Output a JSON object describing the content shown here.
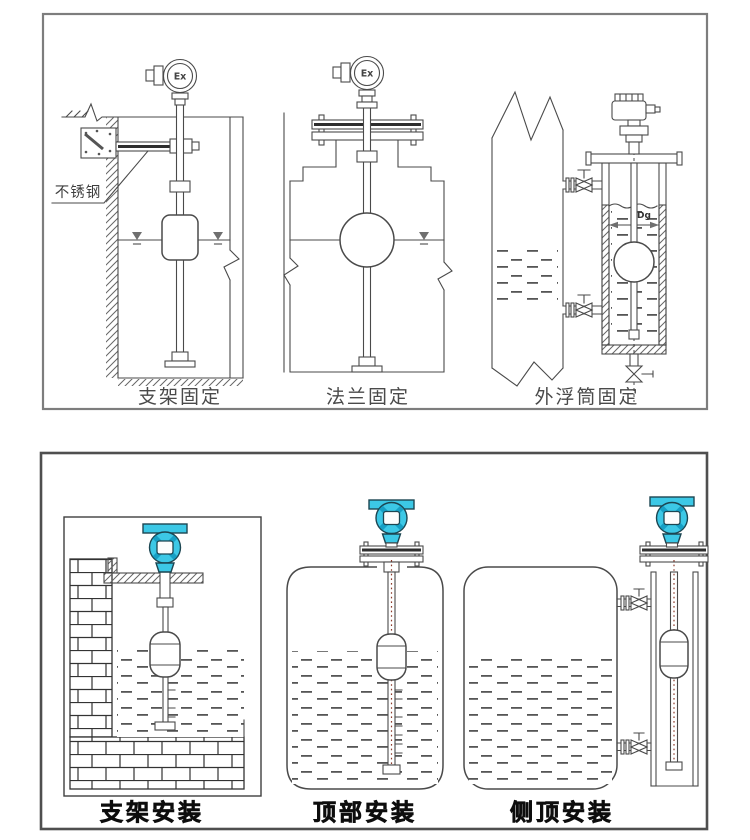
{
  "top_panel": {
    "name": "fixing-methods-panel",
    "captions": [
      "支架固定",
      "法兰固定",
      "外浮筒固定"
    ],
    "stainless_steel_label": "不锈钢",
    "ex_marking": "Ex",
    "dg_label": "Dg"
  },
  "bottom_panel": {
    "name": "installation-methods-panel",
    "captions": [
      "支架安装",
      "顶部安装",
      "侧顶安装"
    ]
  },
  "colors": {
    "line": "#4a4a4a",
    "panel_border_top": "#7d7d7d",
    "panel_border_bottom": "#4f4f4f",
    "transmitter_teal": "#3cc8e6",
    "transmitter_teal_dark": "#169fc4",
    "teal_outline": "#1c4652",
    "stem_centerline": "#8b3a2a"
  }
}
